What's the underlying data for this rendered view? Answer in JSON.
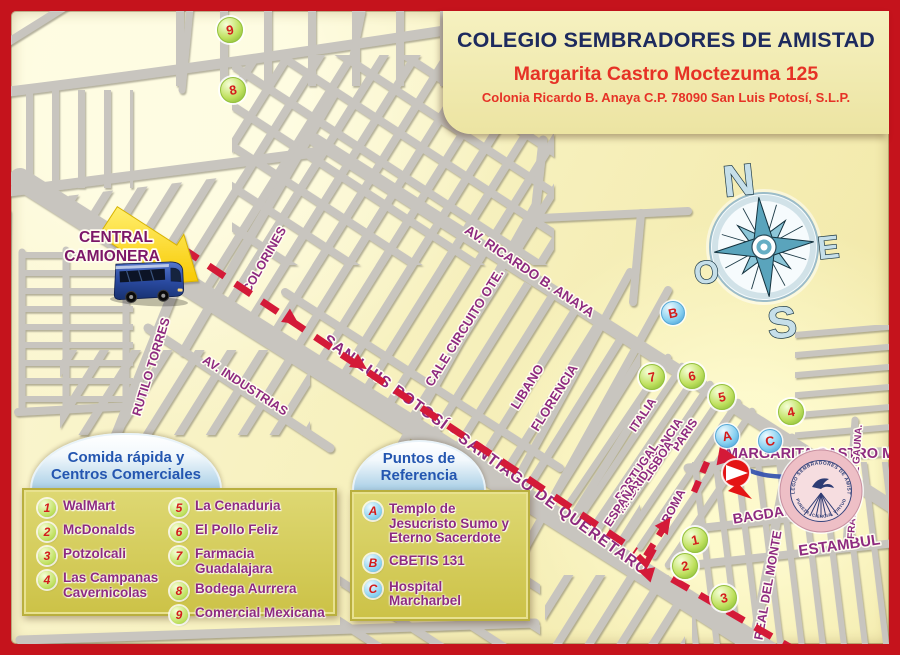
{
  "header": {
    "title": "COLEGIO SEMBRADORES DE AMISTAD",
    "line1": "Margarita Castro Moctezuma 125",
    "line2": "Colonia Ricardo B. Anaya C.P. 78090 San Luis Potosí, S.L.P."
  },
  "central_camionera": {
    "line1": "CENTRAL",
    "line2": "CAMIONERA"
  },
  "compass": {
    "n": "N",
    "e": "E",
    "s": "S",
    "o": "O"
  },
  "streets": {
    "colorines": "COLORINES",
    "rutilo_torres": "RUTILO TORRES",
    "av_industrias": "AV. INDUSTRIAS",
    "av_ricardo": "AV. RICARDO B. ANAYA",
    "circuito": "CALE CIRCUITO OTE.",
    "libano": "LIBANO",
    "florencia": "FLORENCIA",
    "highway": "SAN LUIS POTOSÍ - SANTIAGO DE QUERÉTARO",
    "italia": "ITALIA",
    "francia": "FRANCIA",
    "paris": "PARIS",
    "lisboa": "LISBOA",
    "portugal": "PORTUGAL",
    "madrid": "MADRID",
    "espana": "ESPAÑA",
    "roma": "ROMA",
    "margarita": "MARGARITA CASTRO M.",
    "bagdad": "BAGDAD",
    "estambul": "ESTAMBUL",
    "real_del_monte": "REAL DEL MONTE",
    "fray_jose": "FRAY JOSÉ DE GAUNA."
  },
  "legend_food": {
    "title_line1": "Comida rápida y",
    "title_line2": "Centros Comerciales",
    "items": [
      {
        "num": "1",
        "label": "WalMart"
      },
      {
        "num": "2",
        "label": "McDonalds"
      },
      {
        "num": "3",
        "label": "Potzolcali"
      },
      {
        "num": "4",
        "label": "Las Campanas Cavernicolas"
      },
      {
        "num": "5",
        "label": "La Cenaduria"
      },
      {
        "num": "6",
        "label": "El Pollo Feliz"
      },
      {
        "num": "7",
        "label": "Farmacia Guadalajara"
      },
      {
        "num": "8",
        "label": "Bodega Aurrera"
      },
      {
        "num": "9",
        "label": "Comercial Mexicana"
      }
    ]
  },
  "legend_refs": {
    "title_line1": "Puntos de",
    "title_line2": "Referencia",
    "items": [
      {
        "letter": "A",
        "label": "Templo de Jesucristo Sumo y Eterno Sacerdote"
      },
      {
        "letter": "B",
        "label": "CBETIS 131"
      },
      {
        "letter": "C",
        "label": "Hospital Marcharbel"
      }
    ]
  },
  "map_markers": [
    {
      "label": "9",
      "type": "green"
    },
    {
      "label": "8",
      "type": "green"
    },
    {
      "label": "B",
      "type": "blue"
    },
    {
      "label": "7",
      "type": "green"
    },
    {
      "label": "6",
      "type": "green"
    },
    {
      "label": "5",
      "type": "green"
    },
    {
      "label": "4",
      "type": "green"
    },
    {
      "label": "A",
      "type": "blue"
    },
    {
      "label": "C",
      "type": "blue"
    },
    {
      "label": "1",
      "type": "green"
    },
    {
      "label": "2",
      "type": "green"
    },
    {
      "label": "3",
      "type": "green"
    }
  ],
  "seal": {
    "top_arc": "COLEGIO SEMBRADORES DE AMISTAD",
    "bottom_arc": "PUREZA, CIENCIA, VIRTUD"
  },
  "colors": {
    "frame_red": "#c5131c",
    "map_background": "#f7f1bf",
    "street_gray": "#c8c5bf",
    "route_red": "#d41a38",
    "street_label_purple": "#8e2a80",
    "legend_box_olive": "#d5cb5c",
    "title_navy": "#1d2a5e",
    "subtitle_red": "#e63226",
    "marker_green": "#bfe05e",
    "marker_blue": "#86cff0"
  }
}
